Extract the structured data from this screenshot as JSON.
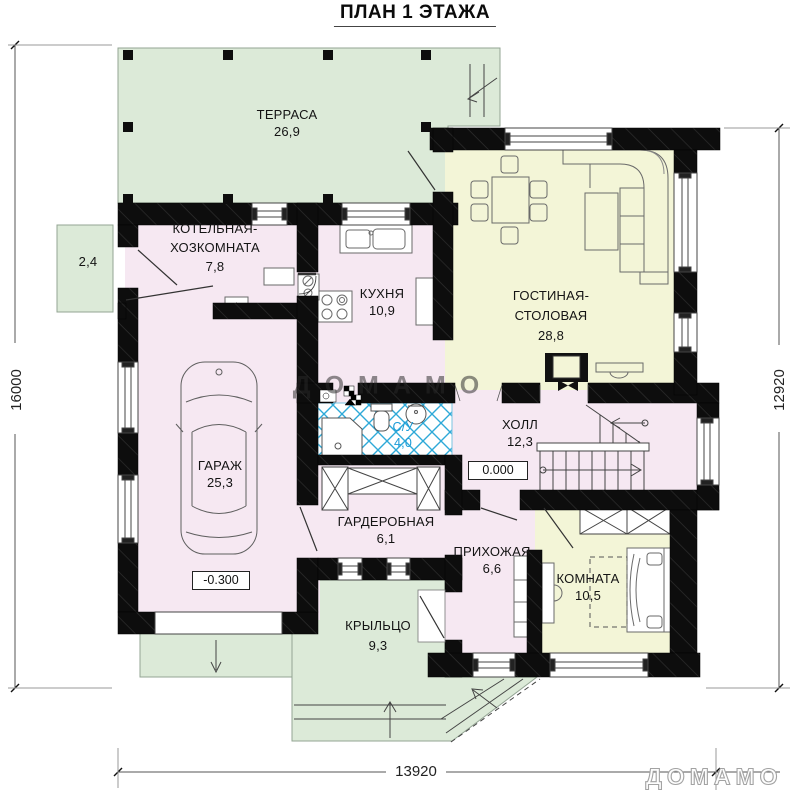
{
  "title": "ПЛАН 1 ЭТАЖА",
  "rooms": {
    "terrace": {
      "name": "ТЕРРАСА",
      "area": "26,9"
    },
    "side_area": {
      "area": "2,4"
    },
    "boiler": {
      "name_line1": "КОТЕЛЬНАЯ-",
      "name_line2": "ХОЗКОМНАТА",
      "area": "7,8"
    },
    "kitchen": {
      "name": "КУХНЯ",
      "area": "10,9"
    },
    "living": {
      "name_line1": "ГОСТИНАЯ-",
      "name_line2": "СТОЛОВАЯ",
      "area": "28,8"
    },
    "garage": {
      "name": "ГАРАЖ",
      "area": "25,3"
    },
    "bathroom": {
      "name": "С/У",
      "area": "4,0"
    },
    "hall": {
      "name": "ХОЛЛ",
      "area": "12,3"
    },
    "wardrobe": {
      "name": "ГАРДЕРОБНАЯ",
      "area": "6,1"
    },
    "entry": {
      "name": "ПРИХОЖАЯ",
      "area": "6,6"
    },
    "bedroom": {
      "name": "КОМНАТА",
      "area": "10,5"
    },
    "porch": {
      "name": "КРЫЛЬЦО",
      "area": "9,3"
    }
  },
  "elevations": {
    "hall": "0.000",
    "garage": "-0.300"
  },
  "dimensions": {
    "left": "16000",
    "right": "12920",
    "bottom": "13920"
  },
  "watermark": {
    "center": "ДОМАМО",
    "corner": "ДОМАМО"
  },
  "colors": {
    "wall": "#0d0d0d",
    "room_pink": "#f6e8f2",
    "room_yellow": "#f3f5d7",
    "outdoor_green": "#dcead8",
    "tile_blue": "#2ea9d8"
  }
}
